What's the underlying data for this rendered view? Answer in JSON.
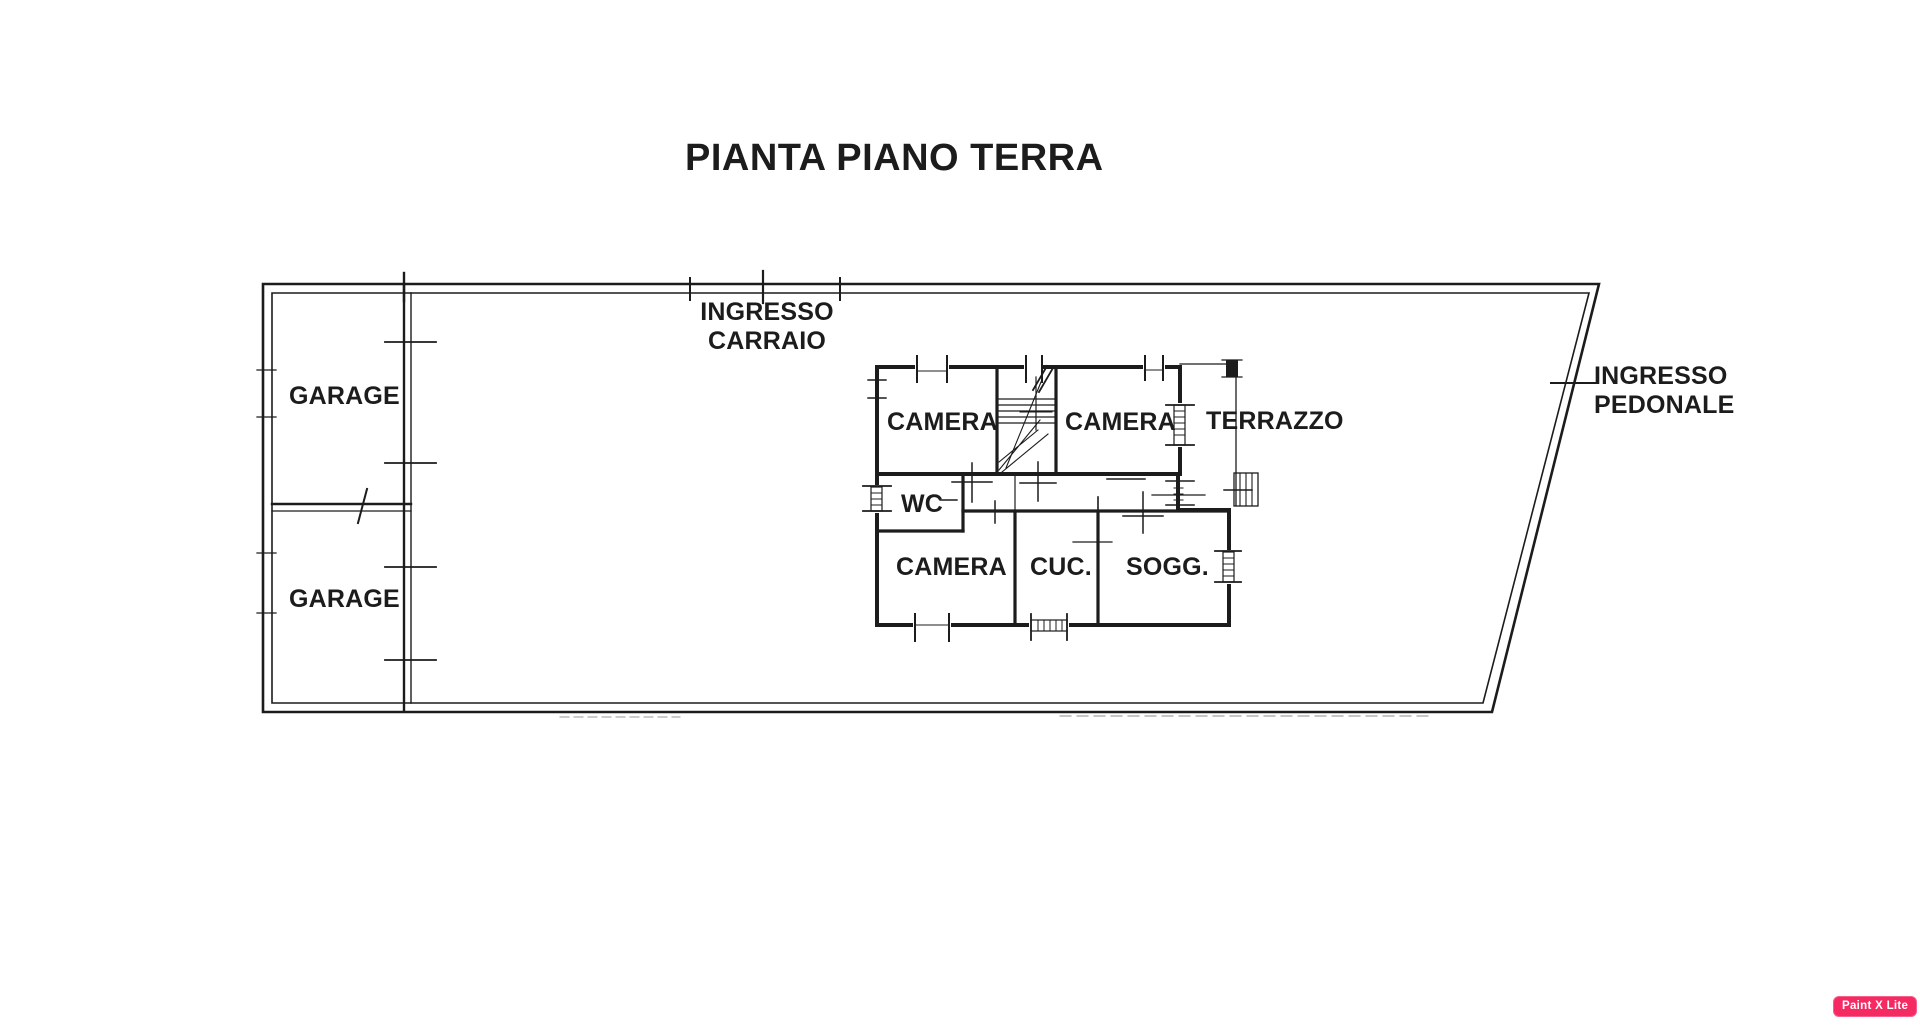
{
  "plan": {
    "title": "PIANTA PIANO TERRA",
    "ink_color": "#1c1c1c",
    "paper_color": "#ffffff",
    "labels": {
      "garage_top": "GARAGE",
      "garage_bottom": "GARAGE",
      "ingresso_carraio_line1": "INGRESSO",
      "ingresso_carraio_line2": "CARRAIO",
      "ingresso_pedonale_line1": "INGRESSO",
      "ingresso_pedonale_line2": "PEDONALE",
      "camera_upper_left": "CAMERA",
      "camera_upper_right": "CAMERA",
      "terrazzo": "TERRAZZO",
      "wc": "WC",
      "camera_lower": "CAMERA",
      "cucina": "CUC.",
      "soggiorno": "SOGG."
    }
  },
  "watermark": {
    "label": "Paint X Lite",
    "background": "#f62a62",
    "text_color": "#ffffff"
  }
}
